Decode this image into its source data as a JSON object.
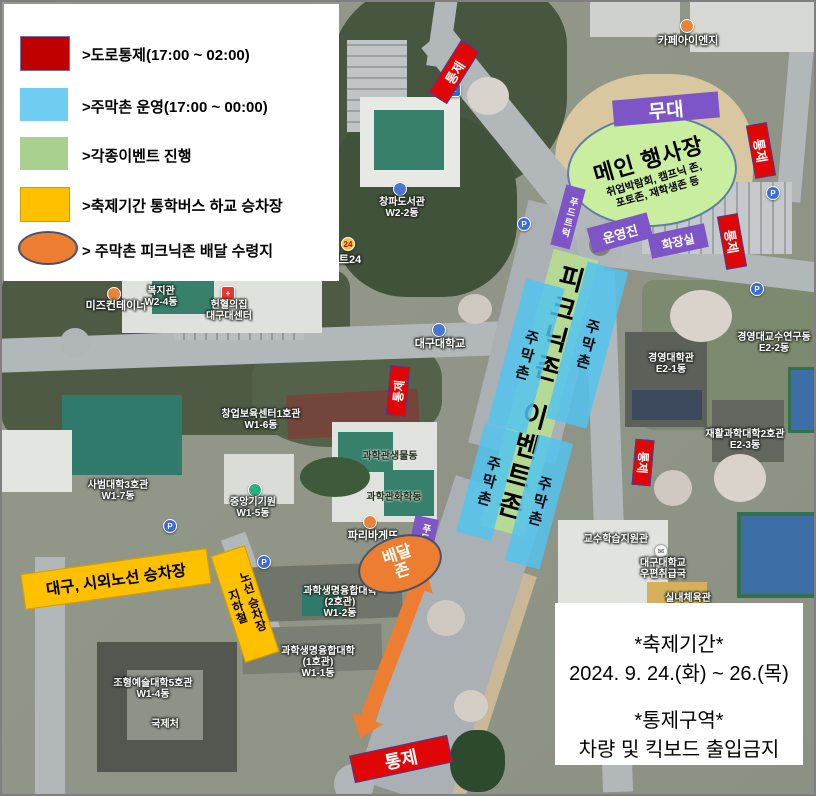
{
  "legend": {
    "items": [
      {
        "label": ">도로통제(17:00 ~ 02:00)",
        "color": "#c00000",
        "shape": "rect"
      },
      {
        "label": ">주막촌 운영(17:00 ~ 00:00)",
        "color": "#70cdf2",
        "shape": "rect"
      },
      {
        "label": ">각종이벤트 진행",
        "color": "#a9d08e",
        "shape": "rect"
      },
      {
        "label": ">축제기간 통학버스 하교 승차장",
        "color": "#ffc000",
        "shape": "rect"
      },
      {
        "label": "> 주막촌 피크닉존 배달 수령지",
        "color": "#ed7d31",
        "shape": "ellipse"
      }
    ]
  },
  "overlays": {
    "control": "통제",
    "stage": "무대",
    "main_venue": {
      "title": "메인 행사장",
      "sub1": "취업박람회, 캠프닉 존,",
      "sub2": "포토존, 재학생존 등"
    },
    "food_truck": "푸드트럭",
    "staff": "운영진",
    "restroom": "화장실",
    "picnic_zone": "피크닉존",
    "event_zone": "이벤트존",
    "jumak_zone": "주막촌",
    "delivery_zone_line1": "배달",
    "delivery_zone_line2": "존",
    "bus_stop_intercity": "대구, 시외노선 승차장",
    "bus_stop_subway_line1": "지하철",
    "bus_stop_subway_line2": "노선 승차장",
    "purple_color": "#7d55c7",
    "control_color": "#e00606",
    "arrow_color": "#ed7d31"
  },
  "info_box": {
    "l1": "*축제기간*",
    "l2": "2024. 9. 24.(화) ~ 26.(목)",
    "l3": "*통제구역*",
    "l4": "차량 및 킥보드 출입금지"
  },
  "poi": [
    {
      "name": "카페아이엔지"
    },
    {
      "name": "창파도서관",
      "sub": "W2-2동"
    },
    {
      "name": "이마트24"
    },
    {
      "name": "미즈컨테이너"
    },
    {
      "name": "복지관",
      "sub": "W2-4동"
    },
    {
      "name": "헌혈의집",
      "sub": "대구대센터"
    },
    {
      "name": "대구대학교"
    },
    {
      "name": "경영대교수연구동",
      "sub": "E2-2동"
    },
    {
      "name": "경영대학관",
      "sub": "E2-1동"
    },
    {
      "name": "재활과학대학2호관",
      "sub": "E2-3동"
    },
    {
      "name": "창업보육센터1호관",
      "sub": "W1-6동"
    },
    {
      "name": "사범대학3호관",
      "sub": "W1-7동"
    },
    {
      "name": "중앙기기원",
      "sub": "W1-5동"
    },
    {
      "name": "과학관생물동"
    },
    {
      "name": "과학관화학동"
    },
    {
      "name": "파리바게뜨"
    },
    {
      "name": "과학생명융합대학",
      "sub": "(2호관)",
      "sub2": "W1-2동"
    },
    {
      "name": "과학생명융합대학",
      "sub": "(1호관)",
      "sub2": "W1-1동"
    },
    {
      "name": "조형예술대학5호관",
      "sub": "W1-4동"
    },
    {
      "name": "국제처"
    },
    {
      "name": "교수학습지원관"
    },
    {
      "name": "대구대학교",
      "sub": "우편취급국"
    },
    {
      "name": "실내체육관"
    }
  ],
  "icons": {
    "parking": "P",
    "emart": "24",
    "postal": "✉",
    "road_sign": "←"
  }
}
